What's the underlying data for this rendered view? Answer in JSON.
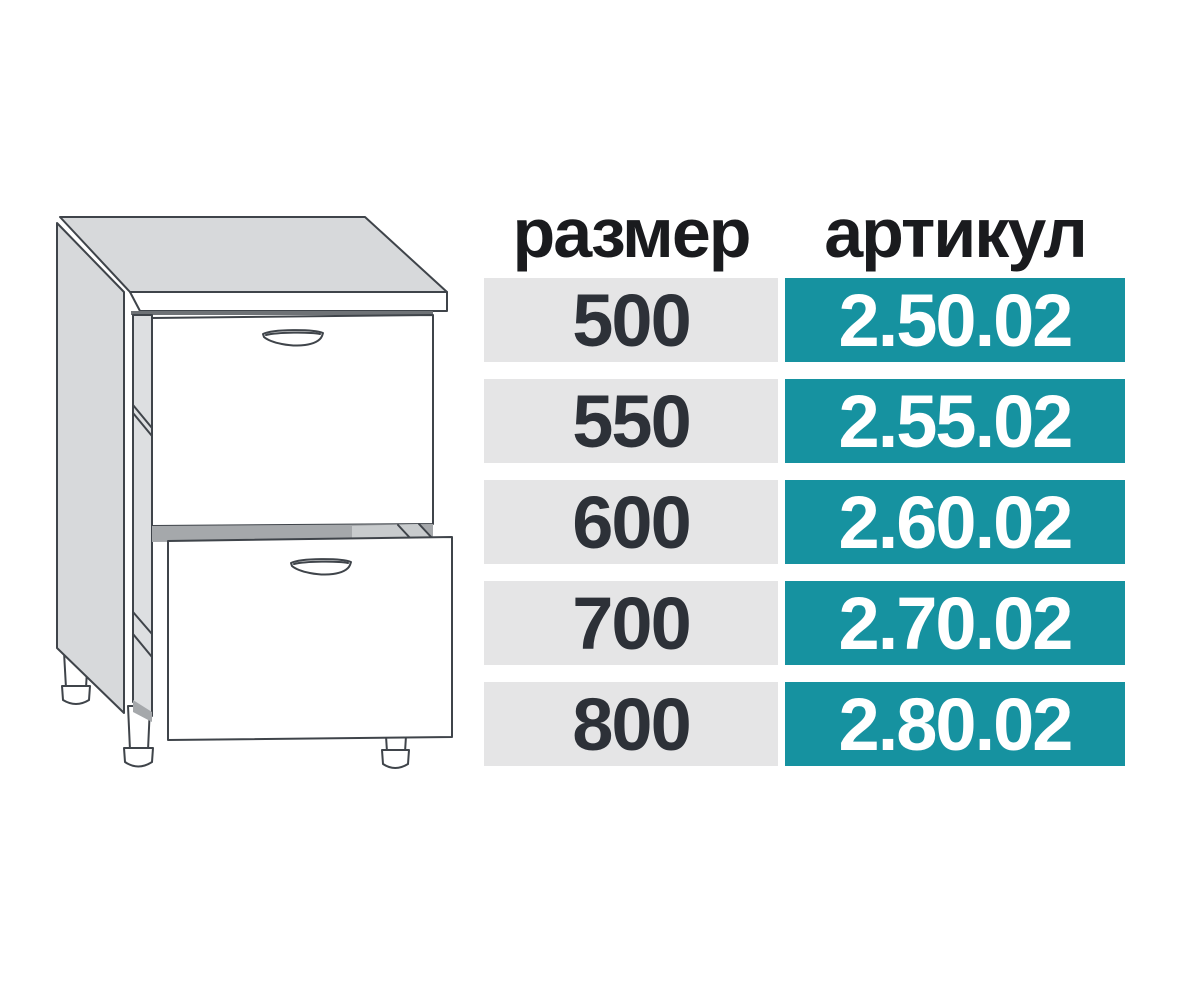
{
  "illustration": {
    "alt": "two-drawer base cabinet line drawing with worktop and adjustable feet"
  },
  "table": {
    "headers": {
      "size": "размер",
      "article": "артикул"
    },
    "rows": [
      {
        "size": "500",
        "article": "2.50.02"
      },
      {
        "size": "550",
        "article": "2.55.02"
      },
      {
        "size": "600",
        "article": "2.60.02"
      },
      {
        "size": "700",
        "article": "2.70.02"
      },
      {
        "size": "800",
        "article": "2.80.02"
      }
    ]
  },
  "colors": {
    "background": "#FFFFFF",
    "teal": "#1692A0",
    "row_gray": "#E5E5E6",
    "header_text": "#1A1B1E",
    "size_text": "#2D3138",
    "article_text": "#FFFFFF",
    "line": "#3F444A",
    "panel_gray": "#D7D9DB",
    "strip_gray": "#DDDFE1",
    "band_dark": "#A5A8AB",
    "band_light": "#C8CBCD",
    "shadow": "#6E7276"
  }
}
